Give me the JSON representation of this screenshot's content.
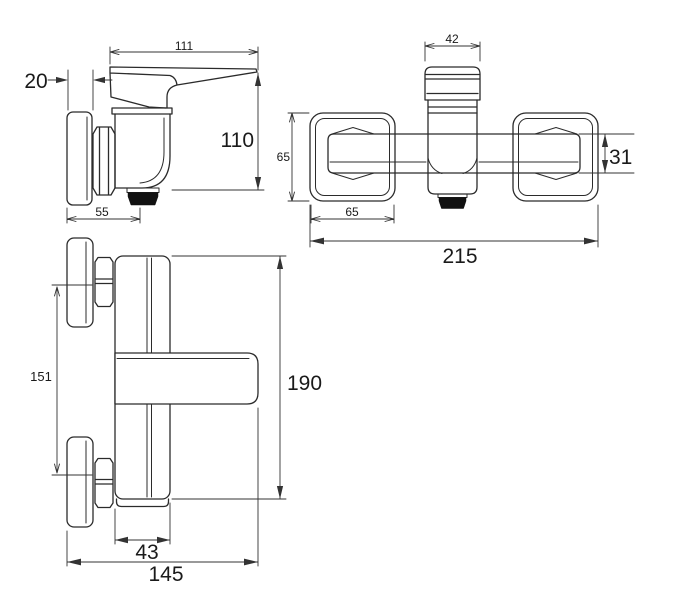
{
  "colors": {
    "background": "#ffffff",
    "line": "#2b2b2b",
    "dimension_text": "#1a1a1a",
    "aerator": "#111111"
  },
  "views": {
    "side": {
      "label": "side-view",
      "dims": {
        "length": "111",
        "plate_thickness": "20",
        "height": "110",
        "depth_to_spout": "55"
      }
    },
    "top": {
      "label": "top-view",
      "dims": {
        "handle_width": "42",
        "rosette_height": "65",
        "bar_height": "31",
        "rosette_width": "65",
        "overall_width": "215"
      }
    },
    "front": {
      "label": "front-view",
      "dims": {
        "connection_spacing": "151",
        "overall_height": "190",
        "body_width": "43",
        "overall_depth": "145"
      }
    }
  }
}
